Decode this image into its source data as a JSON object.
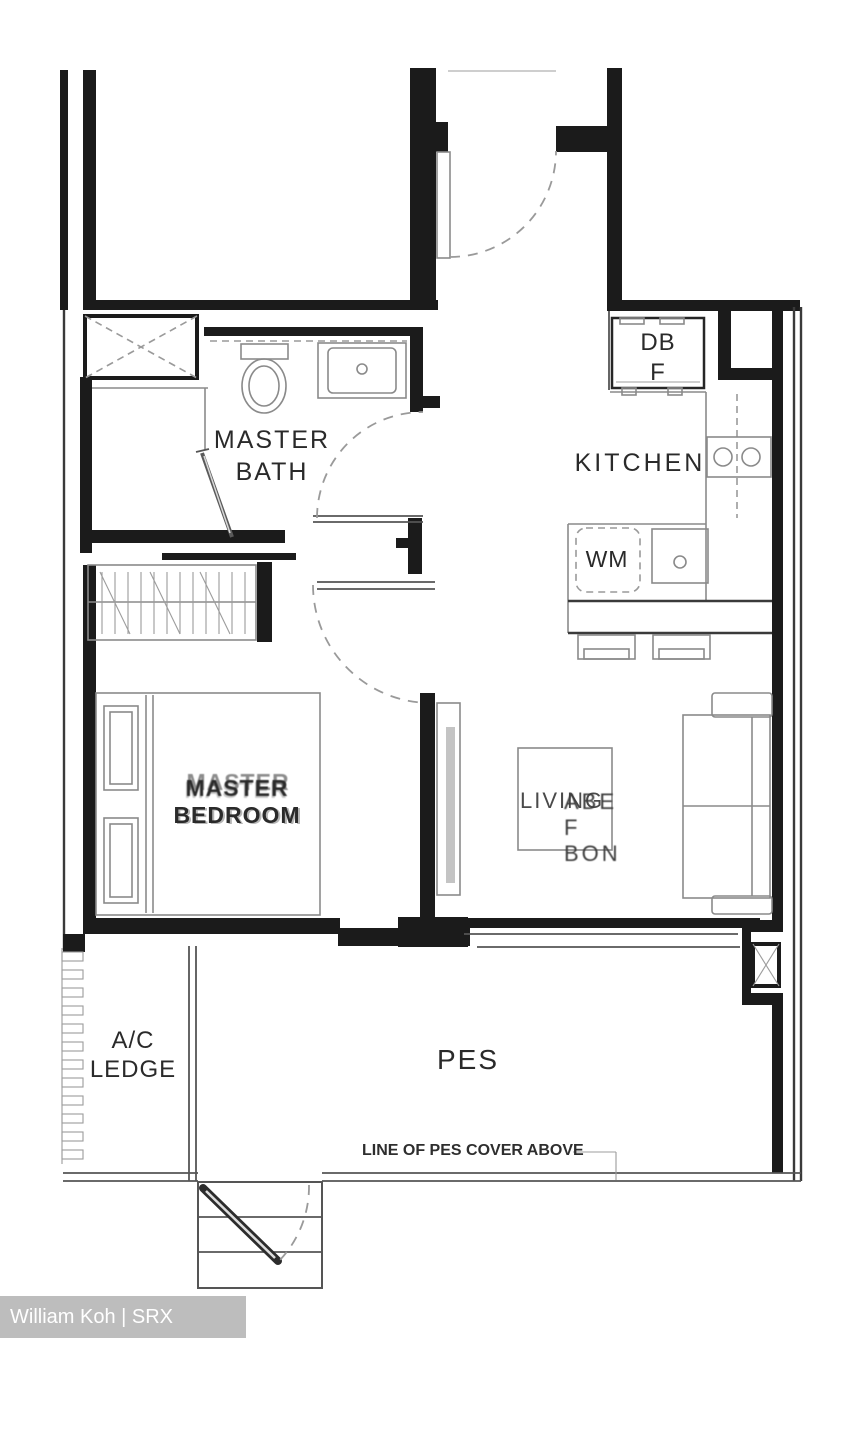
{
  "meta": {
    "watermark": "William Koh | SRX PROPERTY"
  },
  "colors": {
    "wall": "#1b1b1b",
    "fixture": "#8a8a8a",
    "thin": "#555555",
    "dashed": "#9a9a9a",
    "watermark_bg": "#bdbdbd",
    "watermark_text": "#ffffff",
    "paper": "#ffffff",
    "text": "#2a2a2a"
  },
  "rooms": {
    "master_bath": {
      "line1": "MASTER",
      "line2": "BATH"
    },
    "kitchen": {
      "label": "KITCHEN"
    },
    "bedroom": {
      "line1": "MASTER",
      "line2": "BEDROOM"
    },
    "living": {
      "label": "LIVING",
      "overlay": "ABE F BON"
    },
    "ac_ledge": {
      "line1": "A/C",
      "line2": "LEDGE"
    },
    "pes": {
      "label": "PES"
    }
  },
  "fixtures": {
    "db": "DB",
    "f": "F",
    "wm": "WM"
  },
  "notes": {
    "pes_cover": "LINE OF PES COVER ABOVE"
  }
}
